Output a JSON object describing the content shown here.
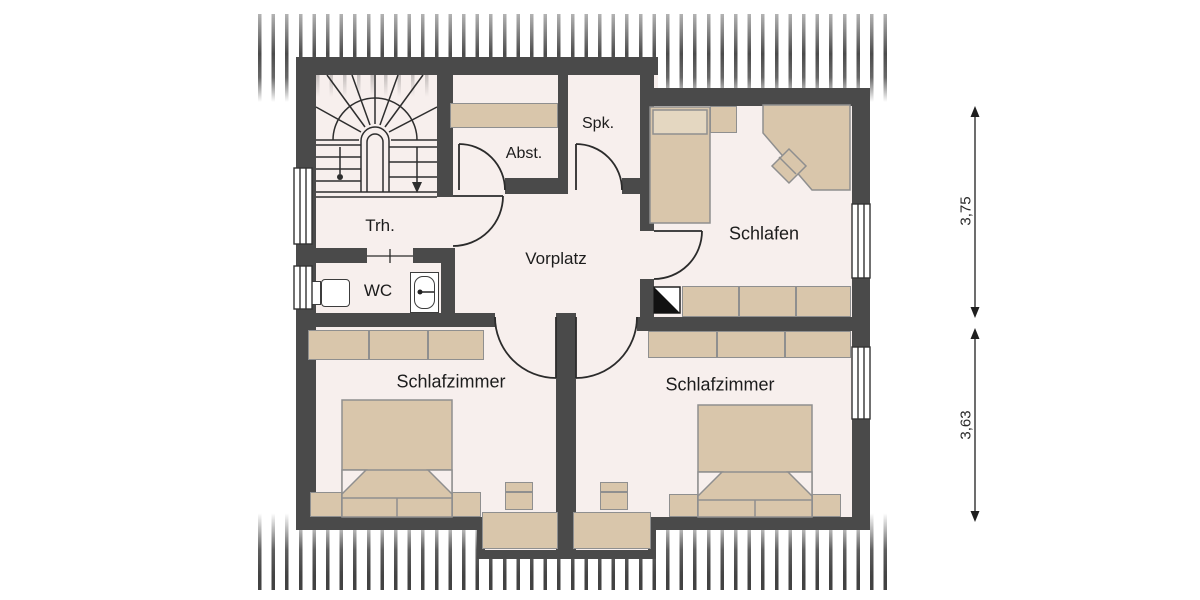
{
  "plan": {
    "type": "floor-plan",
    "floor_name": "upper floor (attic) plan",
    "rooms": {
      "trh": {
        "label": "Trh."
      },
      "wc": {
        "label": "WC"
      },
      "abst": {
        "label": "Abst."
      },
      "spk": {
        "label": "Spk."
      },
      "vorplatz": {
        "label": "Vorplatz"
      },
      "schlafen": {
        "label": "Schlafen"
      },
      "schlafzimmer_left": {
        "label": "Schlafzimmer"
      },
      "schlafzimmer_right": {
        "label": "Schlafzimmer"
      }
    },
    "dimensions": {
      "upper": {
        "value": "3,75"
      },
      "lower": {
        "value": "3,63"
      }
    },
    "colors": {
      "wall": "#4a4a4a",
      "floor": "#f7efed",
      "furniture": "#d9c6ab",
      "pillow": "#e4d7c1",
      "roof_hatch": "#282828",
      "background": "#ffffff"
    }
  }
}
